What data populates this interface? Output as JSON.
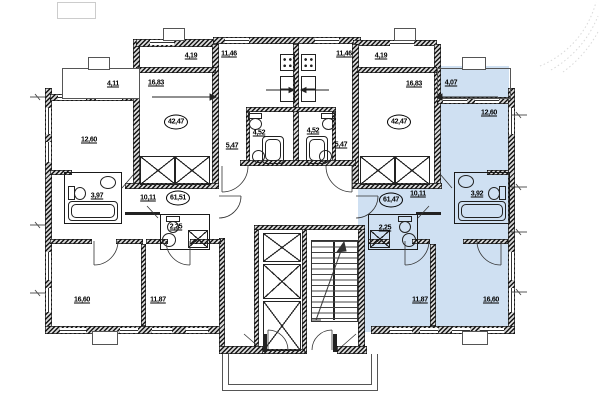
{
  "meta": {
    "drawing_type": "residential-floor-plan",
    "highlight_color": "#cfe0f2",
    "wall_color": "#1a1a1a",
    "line_color": "#333333"
  },
  "labels": [
    {
      "id": "balcony-left",
      "value": "4,11"
    },
    {
      "id": "room-left-bed",
      "value": "16,83"
    },
    {
      "id": "loggia-left",
      "value": "4,19"
    },
    {
      "id": "kitchen-left",
      "value": "11,46"
    },
    {
      "id": "kitchen-right",
      "value": "11,46"
    },
    {
      "id": "loggia-right",
      "value": "4,19"
    },
    {
      "id": "room-right-bed",
      "value": "16,83"
    },
    {
      "id": "balcony-right",
      "value": "4,07"
    },
    {
      "id": "room-left-1260",
      "value": "12,60"
    },
    {
      "id": "room-right-1260",
      "value": "12,60"
    },
    {
      "id": "apartment-total-left",
      "value": "42,47"
    },
    {
      "id": "apartment-total-right",
      "value": "42,47"
    },
    {
      "id": "bath-left-452",
      "value": "4,52"
    },
    {
      "id": "bath-right-452",
      "value": "4,52"
    },
    {
      "id": "hall-left-547",
      "value": "5,47"
    },
    {
      "id": "hall-right-547",
      "value": "5,47"
    },
    {
      "id": "bath-left-397",
      "value": "3,97"
    },
    {
      "id": "corridor-left-1011",
      "value": "10,11"
    },
    {
      "id": "apartment-total-left2",
      "value": "61,51"
    },
    {
      "id": "apartment-total-right2",
      "value": "61,47"
    },
    {
      "id": "corridor-right-1011",
      "value": "10,11"
    },
    {
      "id": "bath-right-392",
      "value": "3,92"
    },
    {
      "id": "wc-left-225",
      "value": "2,25"
    },
    {
      "id": "wc-right-225",
      "value": "2,25"
    },
    {
      "id": "room-bottom-left-1660",
      "value": "16,60"
    },
    {
      "id": "room-bottom-left-1187",
      "value": "11,87"
    },
    {
      "id": "room-bottom-right-1187",
      "value": "11,87"
    },
    {
      "id": "room-bottom-right-1660",
      "value": "16,60"
    }
  ]
}
